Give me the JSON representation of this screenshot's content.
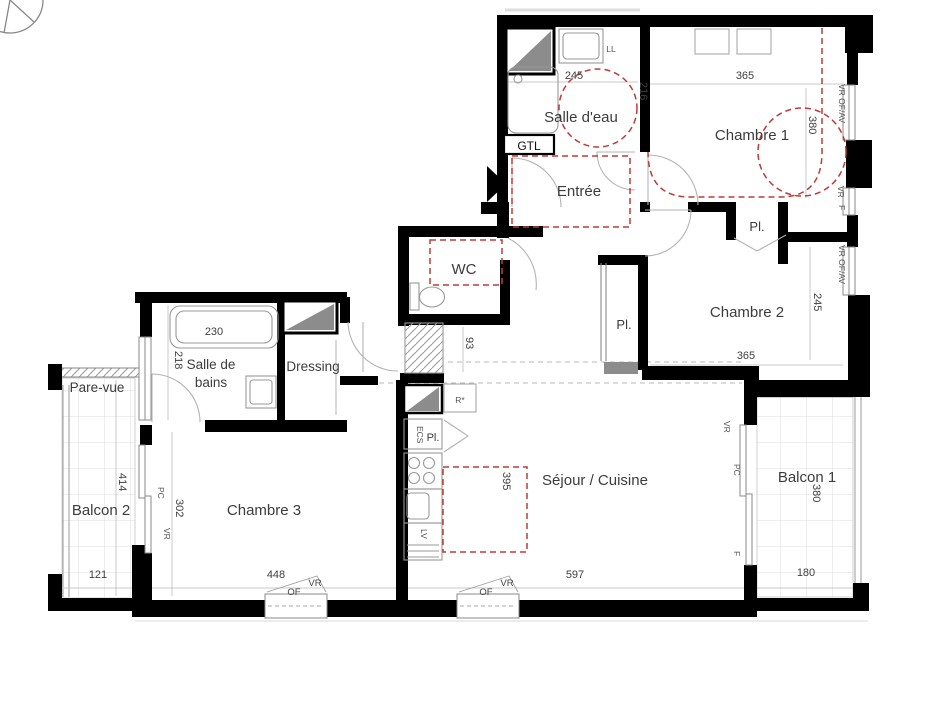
{
  "plan": {
    "rooms": {
      "salle_eau": "Salle d'eau",
      "chambre1": "Chambre 1",
      "entree": "Entrée",
      "wc": "WC",
      "chambre2": "Chambre 2",
      "salle_de_bains_l1": "Salle de",
      "salle_de_bains_l2": "bains",
      "dressing": "Dressing",
      "pare_vue": "Pare-vue",
      "balcon2": "Balcon 2",
      "chambre3": "Chambre 3",
      "sejour": "Séjour / Cuisine",
      "balcon1": "Balcon 1"
    },
    "closets": {
      "pl_hall": "Pl.",
      "pl_chambre2": "Pl.",
      "pl_cuisine": "Pl."
    },
    "dims": {
      "se_w": "245",
      "se_d": "216",
      "c1_w": "365",
      "c1_d": "380",
      "c2_d": "245",
      "c2_w": "365",
      "hall": "93",
      "bath_w": "230",
      "bath_d": "218",
      "b2_d": "414",
      "b2_w": "121",
      "c3_d": "302",
      "c3_w": "448",
      "kitchen": "395",
      "sej_w": "597",
      "b1_w": "180",
      "b1_d": "380"
    },
    "tags": {
      "gtl": "GTL",
      "ll": "LL",
      "ecs": "ECS",
      "lv": "LV",
      "r_star": "R*",
      "vr": "VR",
      "of": "OF",
      "f": "F",
      "pc": "PC",
      "vr_of_av": "VR OF/AV"
    },
    "colors": {
      "wall": "#000000",
      "accessibility_red": "#bf3a3a",
      "shaft_gray": "#8c8c8c"
    }
  }
}
